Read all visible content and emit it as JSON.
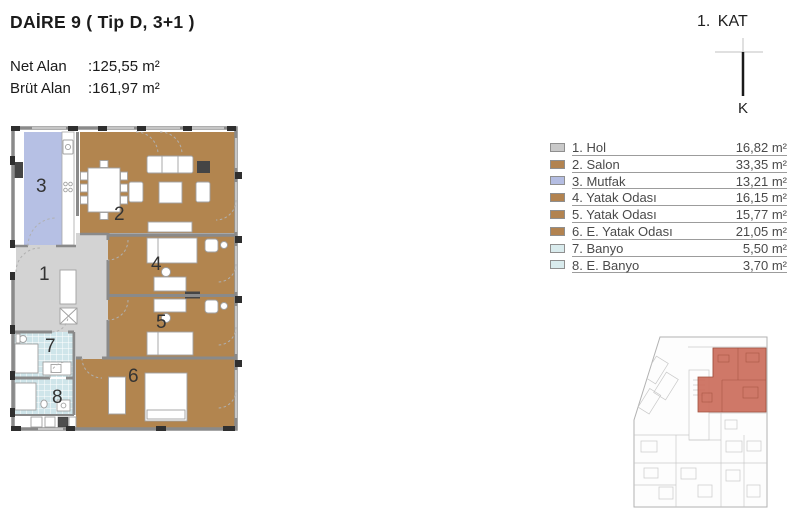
{
  "header": {
    "title": "DAİRE 9 ( Tip D, 3+1 )",
    "net_label": "Net Alan",
    "net_value": ":125,55 m²",
    "brut_label": "Brüt Alan",
    "brut_value": ":161,97 m²"
  },
  "floor_indicator": {
    "label": "1.  KAT",
    "compass_letter": "K"
  },
  "legend": {
    "rooms": [
      {
        "num": "1",
        "label": "1. Hol",
        "area": "16,82 m²",
        "color": "#c9c9c9"
      },
      {
        "num": "2",
        "label": "2. Salon",
        "area": "33,35 m²",
        "color": "#b28350"
      },
      {
        "num": "3",
        "label": "3. Mutfak",
        "area": "13,21 m²",
        "color": "#b4bde2"
      },
      {
        "num": "4",
        "label": "4. Yatak Odası",
        "area": "16,15 m²",
        "color": "#b28350"
      },
      {
        "num": "5",
        "label": "5. Yatak Odası",
        "area": "15,77 m²",
        "color": "#b28350"
      },
      {
        "num": "6",
        "label": "6. E. Yatak Odası",
        "area": "21,05 m²",
        "color": "#b28350"
      },
      {
        "num": "7",
        "label": "7. Banyo",
        "area": "5,50 m²",
        "color": "#d9ebed"
      },
      {
        "num": "8",
        "label": "8. E. Banyo",
        "area": "3,70 m²",
        "color": "#d9ebed"
      }
    ]
  },
  "plan": {
    "hol_color": "#d3d3d3",
    "room_color": "#b2854f",
    "kitchen_color": "#b6c0e4",
    "bath_color": "#cfe5ea",
    "wall_color": "#8a8a8a"
  },
  "keyplan": {
    "highlight_color": "#cb6e5c"
  }
}
